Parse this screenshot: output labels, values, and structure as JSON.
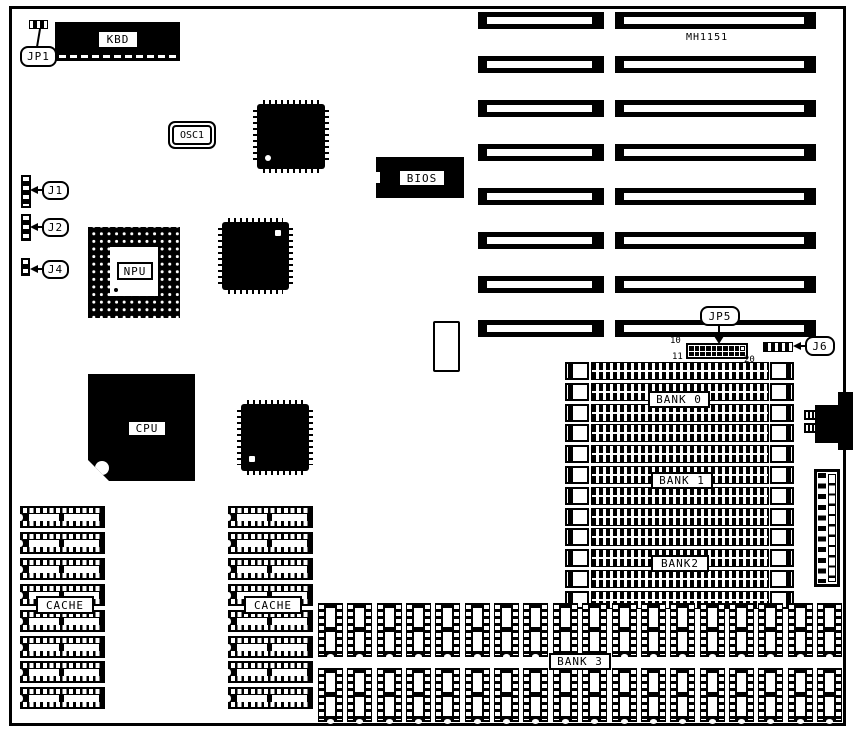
{
  "board": {
    "model": "MH1151",
    "background_color": "#ffffff",
    "line_color": "#000000"
  },
  "callouts": {
    "jp1": "JP1",
    "j1": "J1",
    "j2": "J2",
    "j4": "J4",
    "jp5": "JP5",
    "j6": "J6"
  },
  "components": {
    "kbd": "KBD",
    "osc1": "OSC1",
    "npu": "NPU",
    "cpu": "CPU",
    "bios": "BIOS"
  },
  "memory": {
    "bank0_label": "BANK 0",
    "bank1_label": "BANK 1",
    "bank2_label": "BANK2",
    "bank3_label": "BANK 3",
    "cache_left_label": "CACHE",
    "cache_right_label": "CACHE"
  },
  "jp5_pins": {
    "top_left": "10",
    "bottom_left": "11",
    "bottom_right": "20"
  },
  "counts": {
    "isa_slots": 8,
    "simm_sockets": 12,
    "cache_columns": 2,
    "cache_chips_per_column": 8,
    "bank3_rows": 2,
    "bank3_chips_per_row": 18,
    "jp5_rows": 2,
    "jp5_cols": 10
  }
}
